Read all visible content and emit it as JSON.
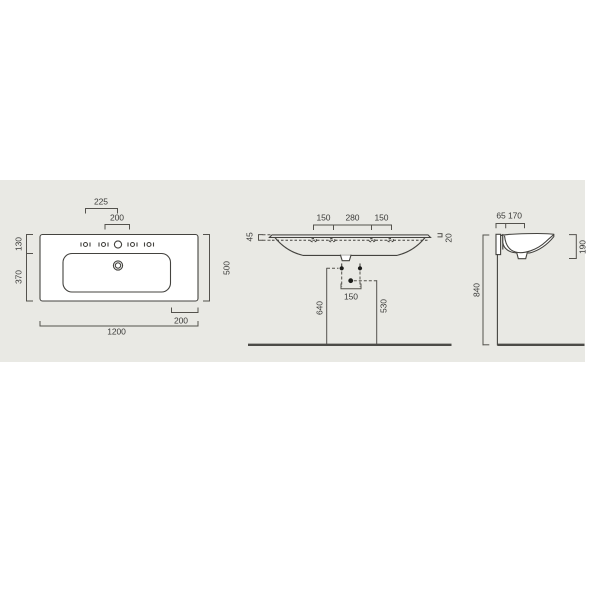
{
  "drawing": {
    "title": "washbasin-technical-drawing-three-views",
    "plan": {
      "dim_hole_offset": "225",
      "dim_hole_pitch": "200",
      "dim_left_top": "130",
      "dim_left_bottom": "370",
      "dim_depth": "500",
      "dim_right_inset": "200",
      "dim_width": "1200"
    },
    "front": {
      "dim_span_left": "150",
      "dim_span_center": "280",
      "dim_span_right": "150",
      "dim_rim_thickness": "45",
      "dim_edge_lip": "20",
      "dim_fixing_pitch": "150",
      "dim_fixing_height": "640",
      "dim_drain_height": "530"
    },
    "side": {
      "dim_bracket_depth": "65",
      "dim_rim_depth": "170",
      "dim_bowl_depth": "190",
      "dim_mount_height": "840"
    },
    "colors": {
      "background": "#ffffff",
      "panel": "#e9e9e4",
      "line": "#44433f",
      "text": "#3a3a38"
    }
  }
}
